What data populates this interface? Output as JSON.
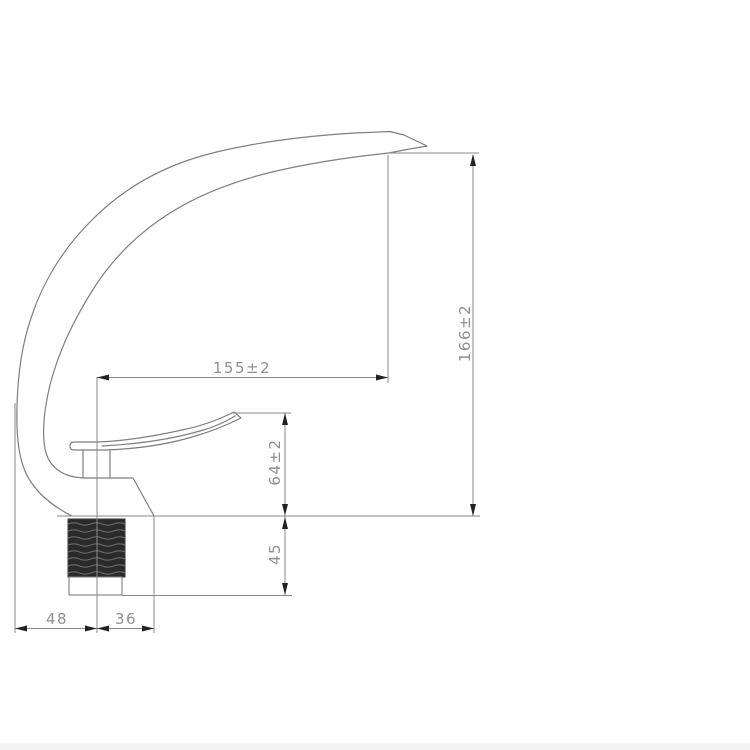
{
  "drawing": {
    "type": "technical-dimension-drawing",
    "subject": "curved basin faucet side profile with threaded mounting shank",
    "dimensions": {
      "spout_reach": "155±2",
      "overall_height": "166±2",
      "body_height": "64±2",
      "shank_length": "45",
      "base_rear_width": "48",
      "base_front_width": "36"
    },
    "colors": {
      "background": "#ffffff",
      "line": "#7f7f7f",
      "label_text": "#8f8f8f",
      "arrow": "#222222",
      "thread_fill": "#2a2a2a",
      "bottom_strip": "#f4f4f4"
    }
  }
}
